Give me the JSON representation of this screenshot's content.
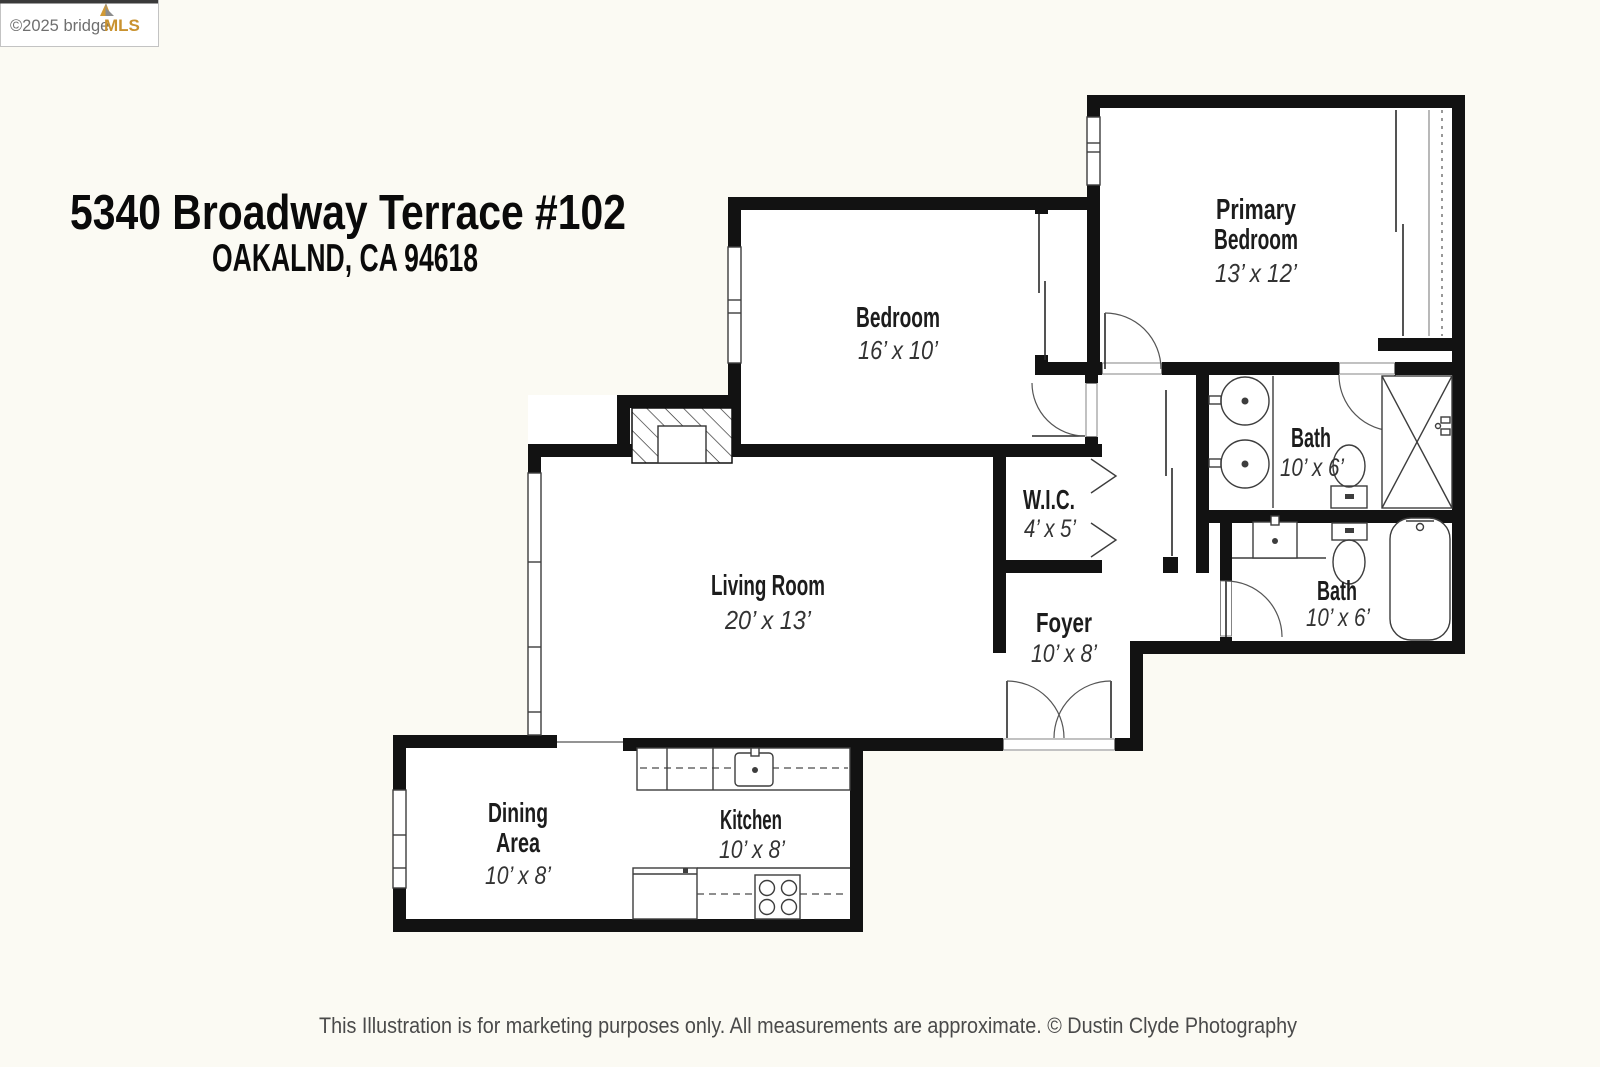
{
  "watermark": {
    "copyright_brand_gray": "©2025 bridge",
    "brand_orange": "MLS"
  },
  "header": {
    "address_line1": "5340 Broadway Terrace #102",
    "address_line2": "OAKALND, CA  94618"
  },
  "rooms": {
    "primary_bedroom": {
      "name_line1": "Primary",
      "name_line2": "Bedroom",
      "dims": "13’ x 12’"
    },
    "bedroom": {
      "name": "Bedroom",
      "dims": "16’ x 10’"
    },
    "bath_primary": {
      "name": "Bath",
      "dims": "10’ x 6’"
    },
    "bath_hall": {
      "name": "Bath",
      "dims": "10’ x 6’"
    },
    "wic": {
      "name": "W.I.C.",
      "dims": "4’ x 5’"
    },
    "living_room": {
      "name": "Living Room",
      "dims": "20’ x 13’"
    },
    "foyer": {
      "name": "Foyer",
      "dims": "10’ x 8’"
    },
    "dining_area": {
      "name_line1": "Dining",
      "name_line2": "Area",
      "dims": "10’ x 8’"
    },
    "kitchen": {
      "name": "Kitchen",
      "dims": "10’ x 8’"
    }
  },
  "footer": {
    "disclaimer": "This Illustration is for marketing purposes only.  All measurements are approximate.  © Dustin Clyde Photography"
  },
  "colors": {
    "wall": "#121212",
    "thin_line": "#3d3d3d",
    "brand_orange": "#c9922f",
    "text": "#1c1c1c"
  }
}
